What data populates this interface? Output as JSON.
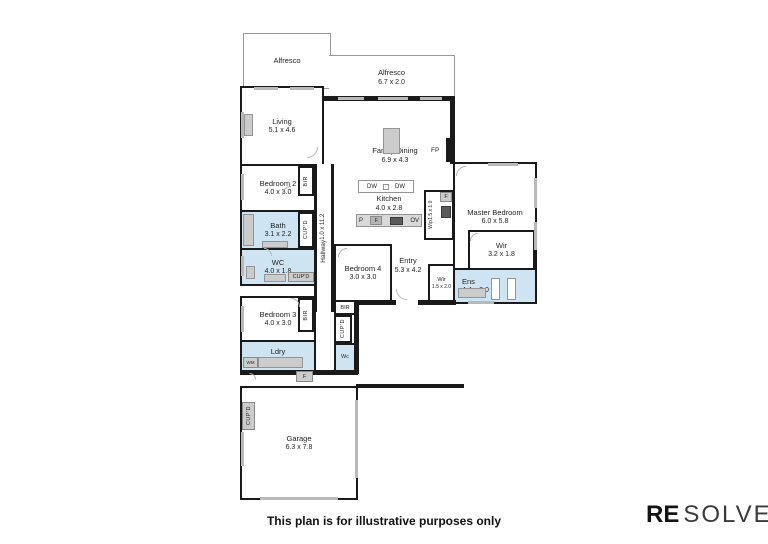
{
  "page": {
    "disclaimer": "This plan is for illustrative purposes only"
  },
  "brand": {
    "bold": "RE",
    "light": "SOLVE"
  },
  "rooms": {
    "alfresco_left": {
      "name": "Alfresco",
      "dims": ""
    },
    "alfresco_right": {
      "name": "Alfresco",
      "dims": "6.7 x 2.0"
    },
    "living": {
      "name": "Living",
      "dims": "5.1 x 4.6"
    },
    "family_dining": {
      "name": "Family/Dining",
      "dims": "6.9 x 4.3"
    },
    "kitchen": {
      "name": "Kitchen",
      "dims": "4.0 x 2.8"
    },
    "wip": {
      "name": "Wip",
      "dims": "1.5 x 1.0"
    },
    "bedroom2": {
      "name": "Bedroom 2",
      "dims": "4.0 x 3.0"
    },
    "bath": {
      "name": "Bath",
      "dims": "3.1 x 2.2"
    },
    "wc": {
      "name": "WC",
      "dims": "4.0 x 1.8"
    },
    "hallway": {
      "name": "Hallway",
      "dims": "1.0 x 11.2"
    },
    "bedroom4": {
      "name": "Bedroom 4",
      "dims": "3.0 x 3.0"
    },
    "entry": {
      "name": "Entry",
      "dims": "5.3 x 4.2"
    },
    "master_bedroom": {
      "name": "Master Bedroom",
      "dims": "6.0 x 5.8"
    },
    "wir_master": {
      "name": "Wir",
      "dims": "3.2 x 1.8"
    },
    "wir_small": {
      "name": "Wir",
      "dims": "1.5 x 2.0"
    },
    "ens": {
      "name": "Ens",
      "dims": "4.4 x 2.0"
    },
    "bedroom3": {
      "name": "Bedroom 3",
      "dims": "4.0 x 3.0"
    },
    "ldry": {
      "name": "Ldry",
      "dims": "4.0 x 1.7"
    },
    "wc_small": {
      "name": "Wc",
      "dims": ""
    },
    "garage": {
      "name": "Garage",
      "dims": "6.3 x 7.8"
    }
  },
  "labels": {
    "fp": "FP",
    "dw_left": "DW",
    "dw_right": "DW",
    "pantry": "P",
    "fridge_kitchen": "F",
    "oven": "OV",
    "fridge_wip": "F",
    "fridge_ldry": "F",
    "washing_machine": "WM",
    "bir_bed2": "BIR",
    "bir_bed3": "BIR",
    "bir_entry": "BIR",
    "cupd_bath": "CUP'D",
    "cupd_wc": "CUP'D",
    "cupd_entry": "CUP'D",
    "cupd_garage": "CUP'D"
  },
  "colors": {
    "wall": "#1a1a1a",
    "wet_area": "#cfe4f2",
    "window": "#b9b9b9",
    "fixture": "#cccccc"
  }
}
